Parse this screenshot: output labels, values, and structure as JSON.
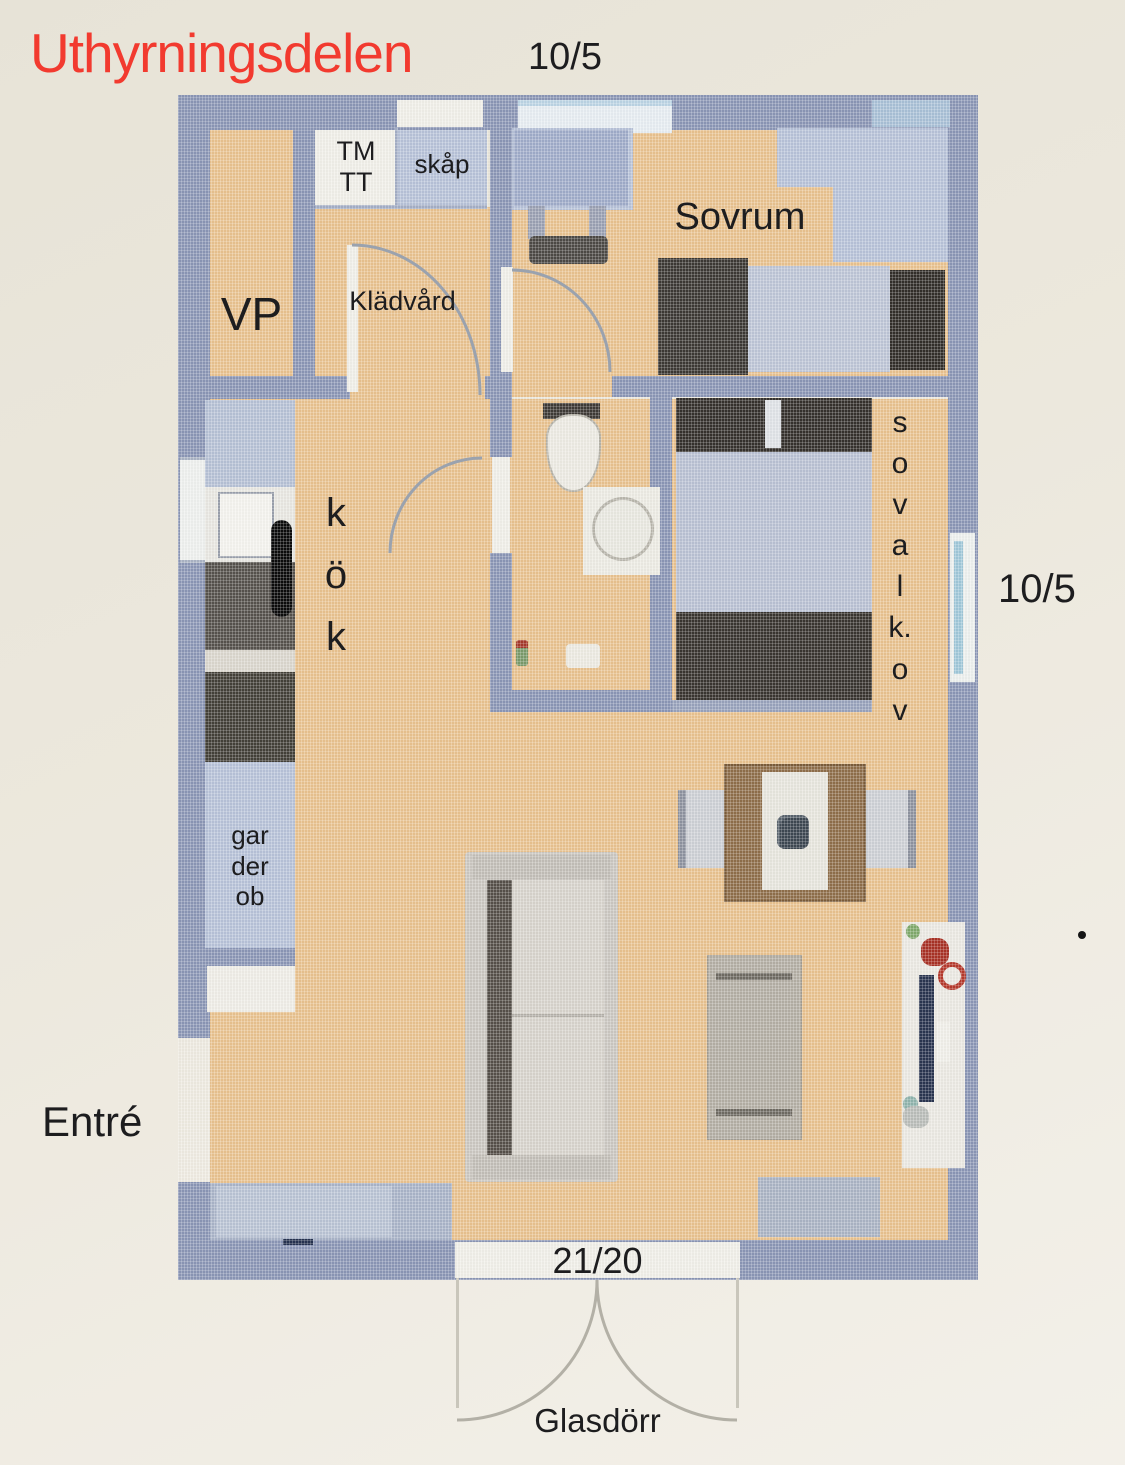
{
  "title": {
    "text": "Uthyrningsdelen",
    "date": "10/5"
  },
  "labels": {
    "vp": "VP",
    "tm": "TM",
    "tt": "TT",
    "skap": "skåp",
    "kladvard": "Klädvård",
    "sovrum": "Sovrum",
    "kok": [
      "k",
      "ö",
      "k"
    ],
    "sovalkov": [
      "s",
      "o",
      "v",
      "a",
      "l",
      "k.",
      "o",
      "v"
    ],
    "garderob": [
      "gar",
      "der",
      "ob"
    ],
    "entre": "Entré",
    "right_measure": "10/5",
    "door_measure": "21/20",
    "glass_door": "Glasdörr"
  },
  "colors": {
    "bg": "#ece8de",
    "accent": "#f23a2f",
    "ink": "#1d1d1f",
    "wall": "#8b96b5",
    "floor": "#e9c28f",
    "carpet": "#b7c2d8",
    "white": "#f0efe8",
    "dark": "#3a3631",
    "stove": "#56524c",
    "fridge": "#434038",
    "table": "#8f6e4a",
    "navy": "#2a3550",
    "sofa": "#cbc7c1",
    "arc": "#9aa2ae"
  }
}
